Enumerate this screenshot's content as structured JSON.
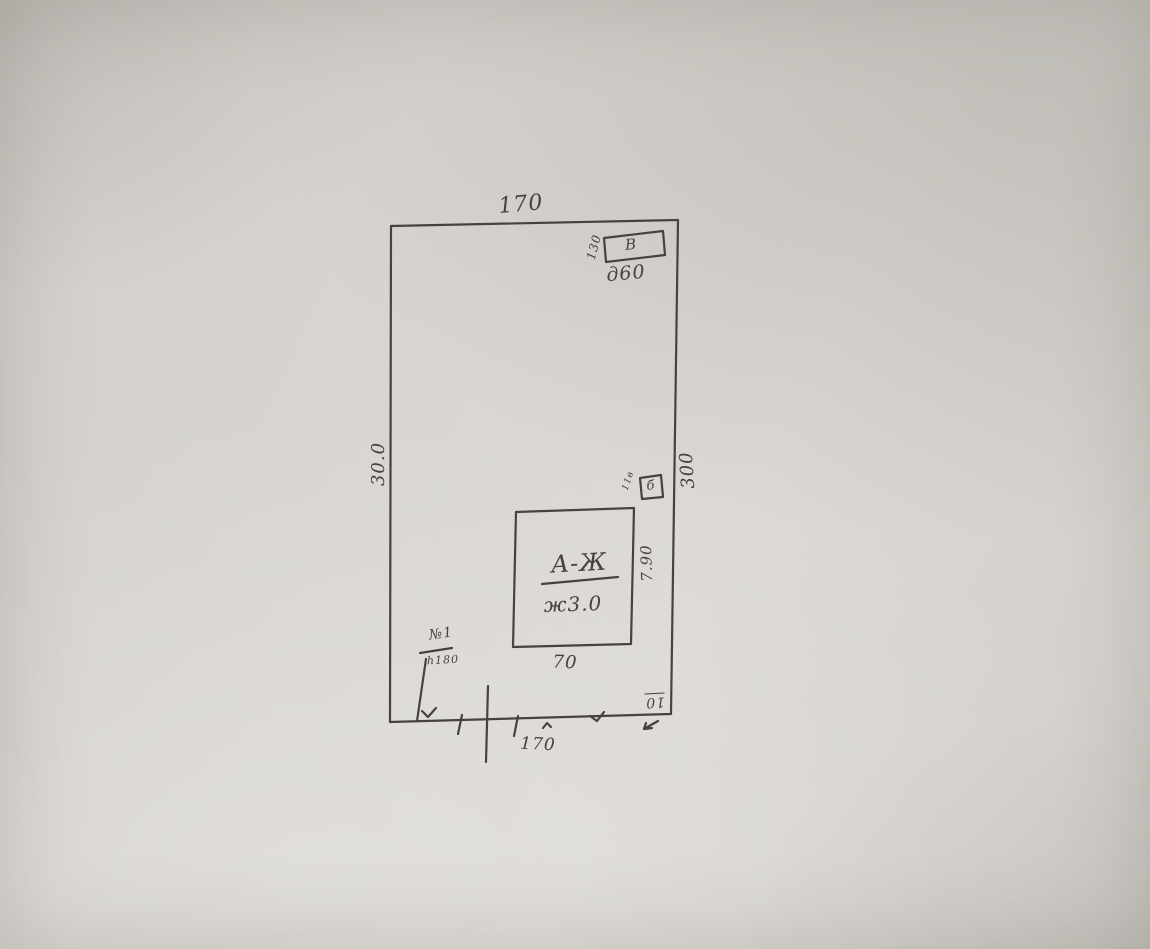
{
  "colors": {
    "ink": "#45433c",
    "paper": "#d6d3ce"
  },
  "plan": {
    "plot": {
      "top_dim": "170",
      "left_dim": "30.0",
      "right_dim": "300",
      "street_bottom_dim": "170",
      "corner_dim": "10"
    },
    "building": {
      "label": "А-Ж",
      "note": "ж3.0",
      "width_dim": "70",
      "height_dim": "7.90"
    },
    "shed_top": {
      "letter": "В",
      "side_dim": "130",
      "width_dim": "д60"
    },
    "shed_mid": {
      "letter": "б",
      "side_dim": "11в"
    },
    "gate": {
      "label": "№1",
      "height_note": "h180"
    }
  }
}
